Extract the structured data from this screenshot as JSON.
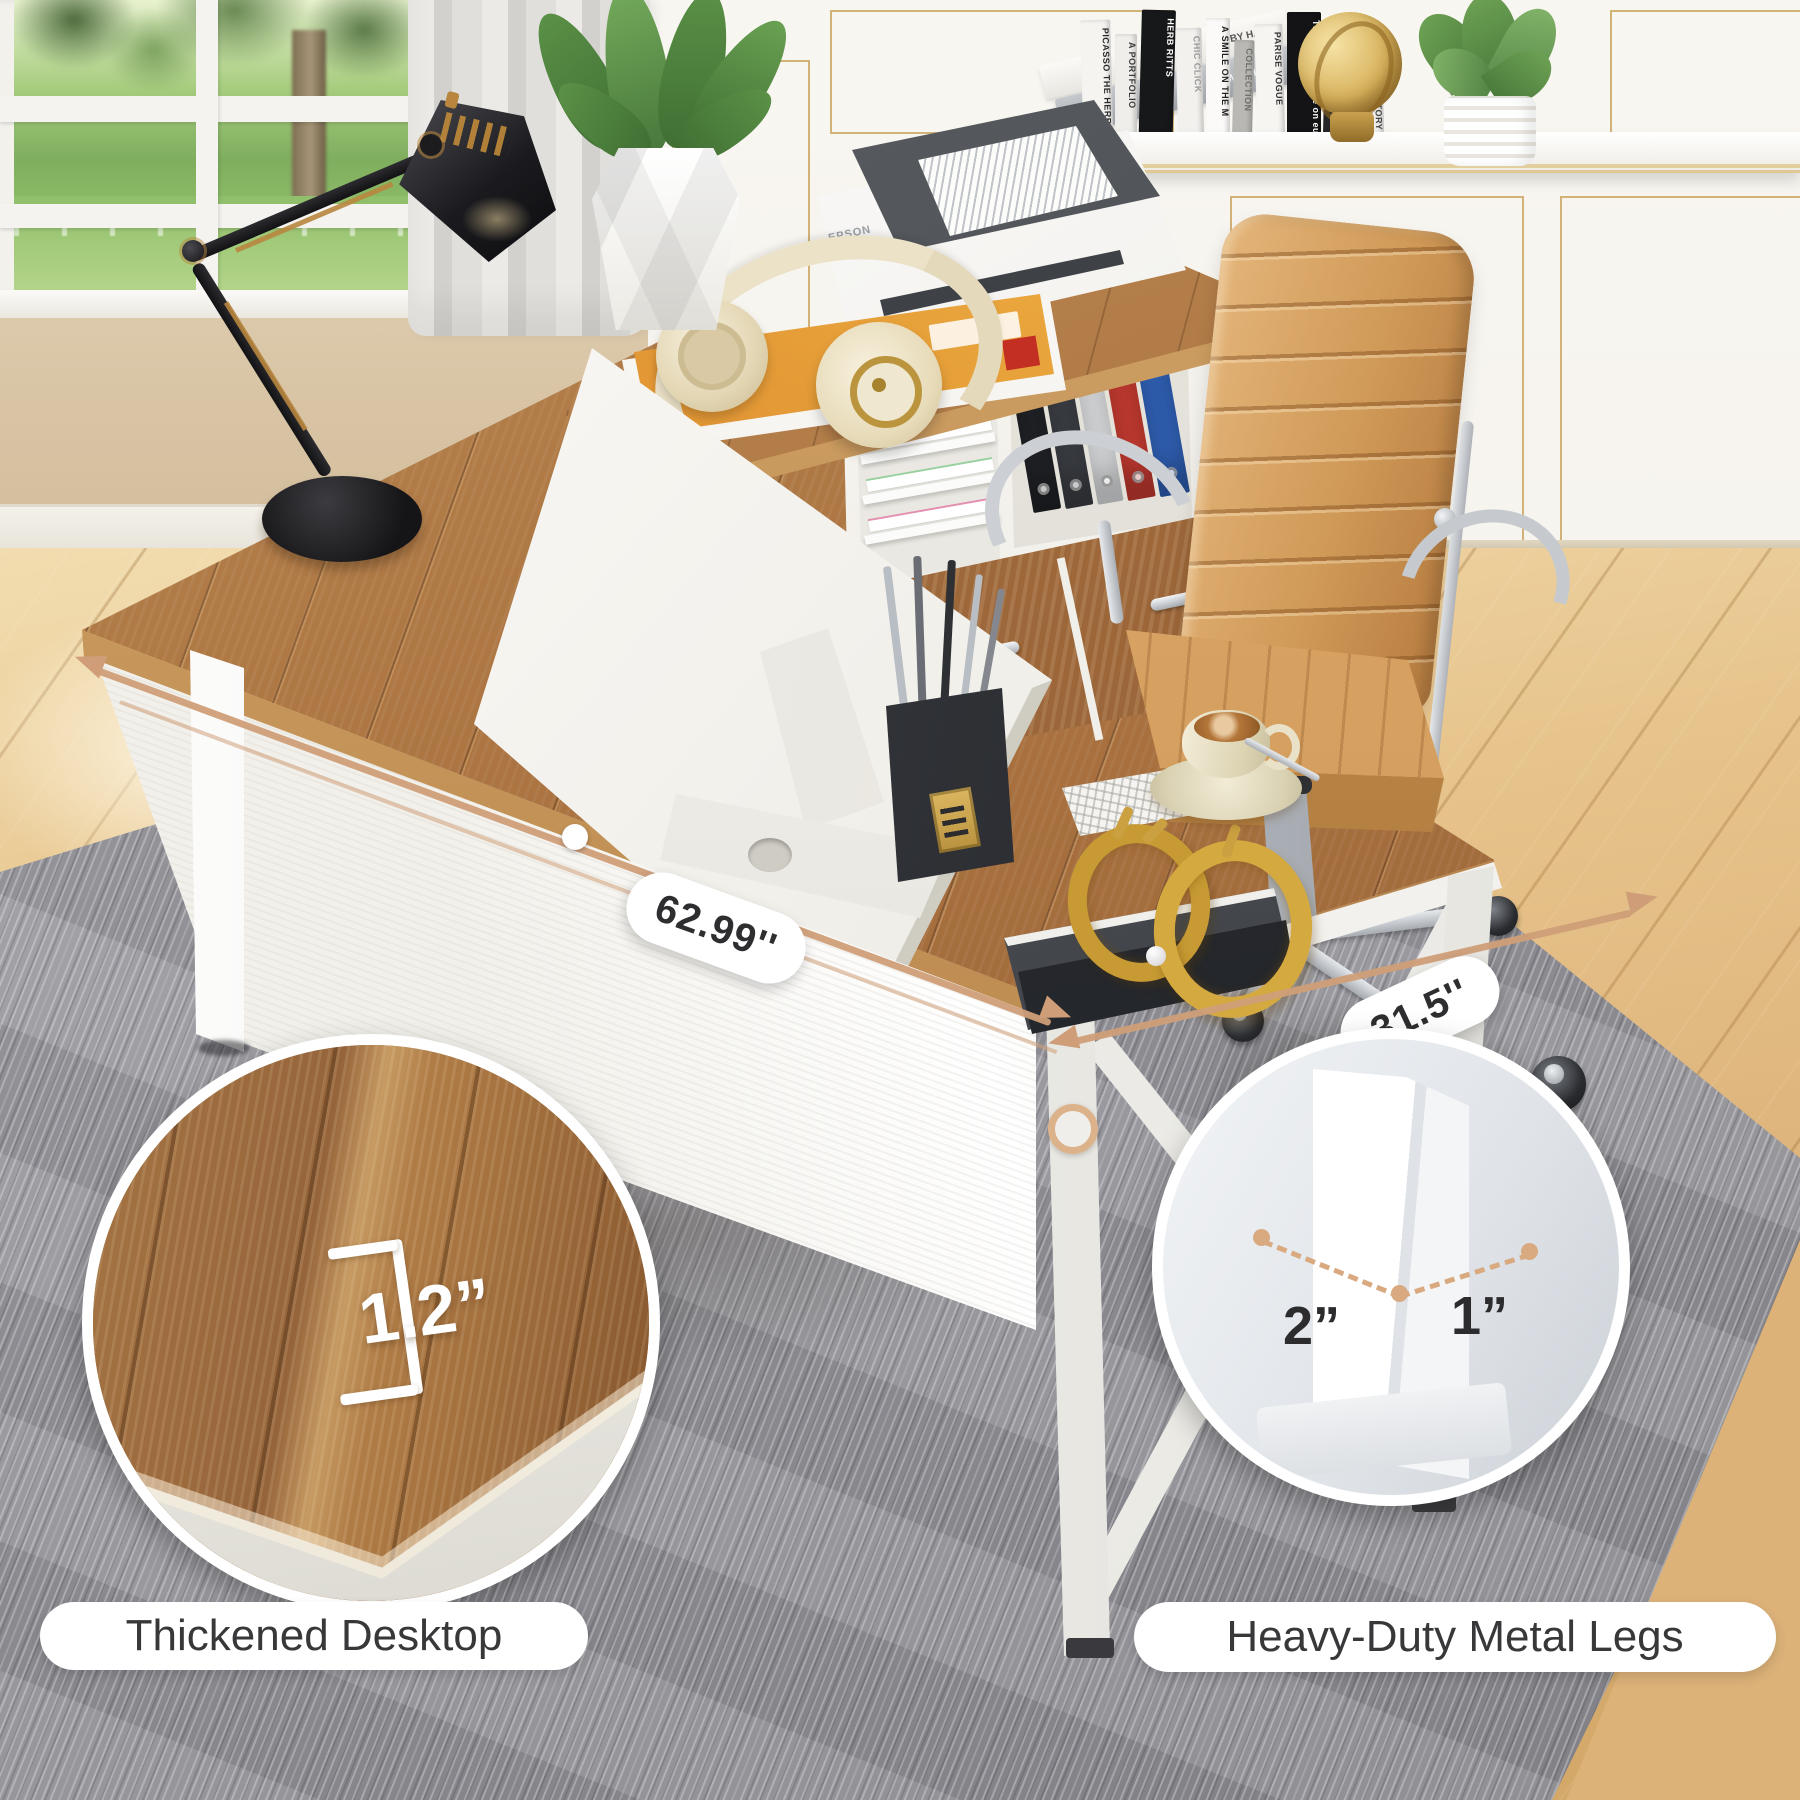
{
  "annotations": {
    "desk_width": "62.99''",
    "desk_depth": "31.5''",
    "desktop_thickness": "1.2”",
    "leg_width": "2”",
    "leg_depth": "1”",
    "callout_left": "Thickened Desktop",
    "callout_right": "Heavy-Duty Metal Legs"
  },
  "objects": {
    "printer_brand": "EPSON",
    "shelf": {
      "flat_books": [
        {
          "title": "BY HAND"
        },
        {
          "title": "DREW SIMONS"
        }
      ],
      "books": [
        {
          "title": "PICASSO THE HERB",
          "bg": "#f5f4f1",
          "fg": "#2a2a2a"
        },
        {
          "title": "A PORTFOLIO",
          "bg": "#efeeea",
          "fg": "#3a3a3a"
        },
        {
          "title": "HERB RITTS",
          "bg": "#17181a",
          "fg": "#ffffff"
        },
        {
          "title": "CHIC CLICK",
          "bg": "#f2f1ee",
          "fg": "#9a9a98"
        },
        {
          "title": "A SMILE ON THE M",
          "bg": "#fbfaf8",
          "fg": "#222222"
        },
        {
          "title": "COLLECTION",
          "bg": "#b9b8b4",
          "fg": "#6d6d6a"
        },
        {
          "title": "PARISE VOGUE",
          "bg": "#f6f5f2",
          "fg": "#333333"
        },
        {
          "title": "THE BEST OF eye on europe",
          "bg": "#141416",
          "fg": "#ffffff"
        },
        {
          "title": "VOGUE",
          "bg": "#26262a",
          "fg": "#ffffff"
        },
        {
          "title": "THE WALKER STORY",
          "bg": "#efeeeb",
          "fg": "#444444"
        }
      ]
    }
  },
  "colors": {
    "accent_dimension": "#cf9e78",
    "desk_wood": "#a9713f",
    "floor_wood": "#e6c28c",
    "rug_gray": "#9a9aa0",
    "chair_tan": "#d7a366",
    "pill_bg": "#ffffff",
    "callout_text": "#38383a"
  }
}
